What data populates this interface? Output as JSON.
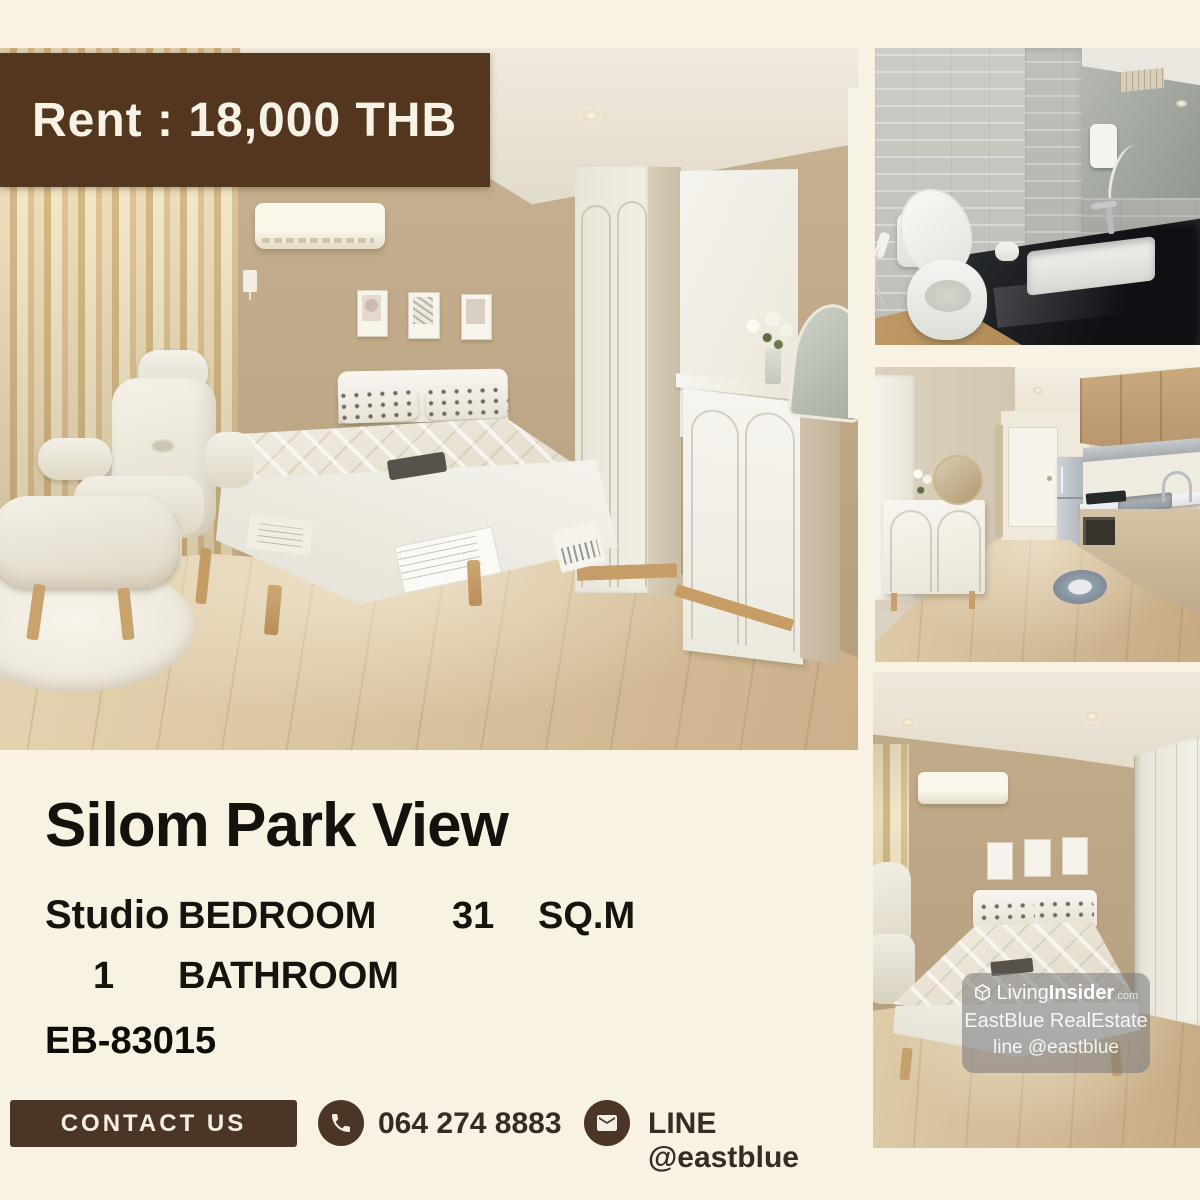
{
  "colors": {
    "background": "#f8f2e3",
    "banner_bg": "#523620",
    "banner_text": "#f7f2e6",
    "contact_accent": "#4a3526",
    "contact_text": "#342d25",
    "title_text": "#15120e"
  },
  "banner": {
    "text": "Rent : 18,000 THB"
  },
  "listing": {
    "title": "Silom Park View",
    "unit_type": "Studio",
    "bedroom_label": "BEDROOM",
    "area_value": "31",
    "area_unit": "SQ.M",
    "bathroom_count": "1",
    "bathroom_label": "BATHROOM",
    "listing_code": "EB-83015"
  },
  "contact": {
    "button_label": "CONTACT US",
    "phone_number": "064 274 8883",
    "line_label": "LINE @eastblue",
    "icons": {
      "phone": "phone-icon",
      "mail": "mail-icon"
    }
  },
  "watermark": {
    "icon": "cube-logo-icon",
    "brand_prefix": "Living",
    "brand_bold": "Insider",
    "brand_tld": ".com",
    "agency": "EastBlue RealEstate",
    "line_handle": "line @eastblue"
  }
}
